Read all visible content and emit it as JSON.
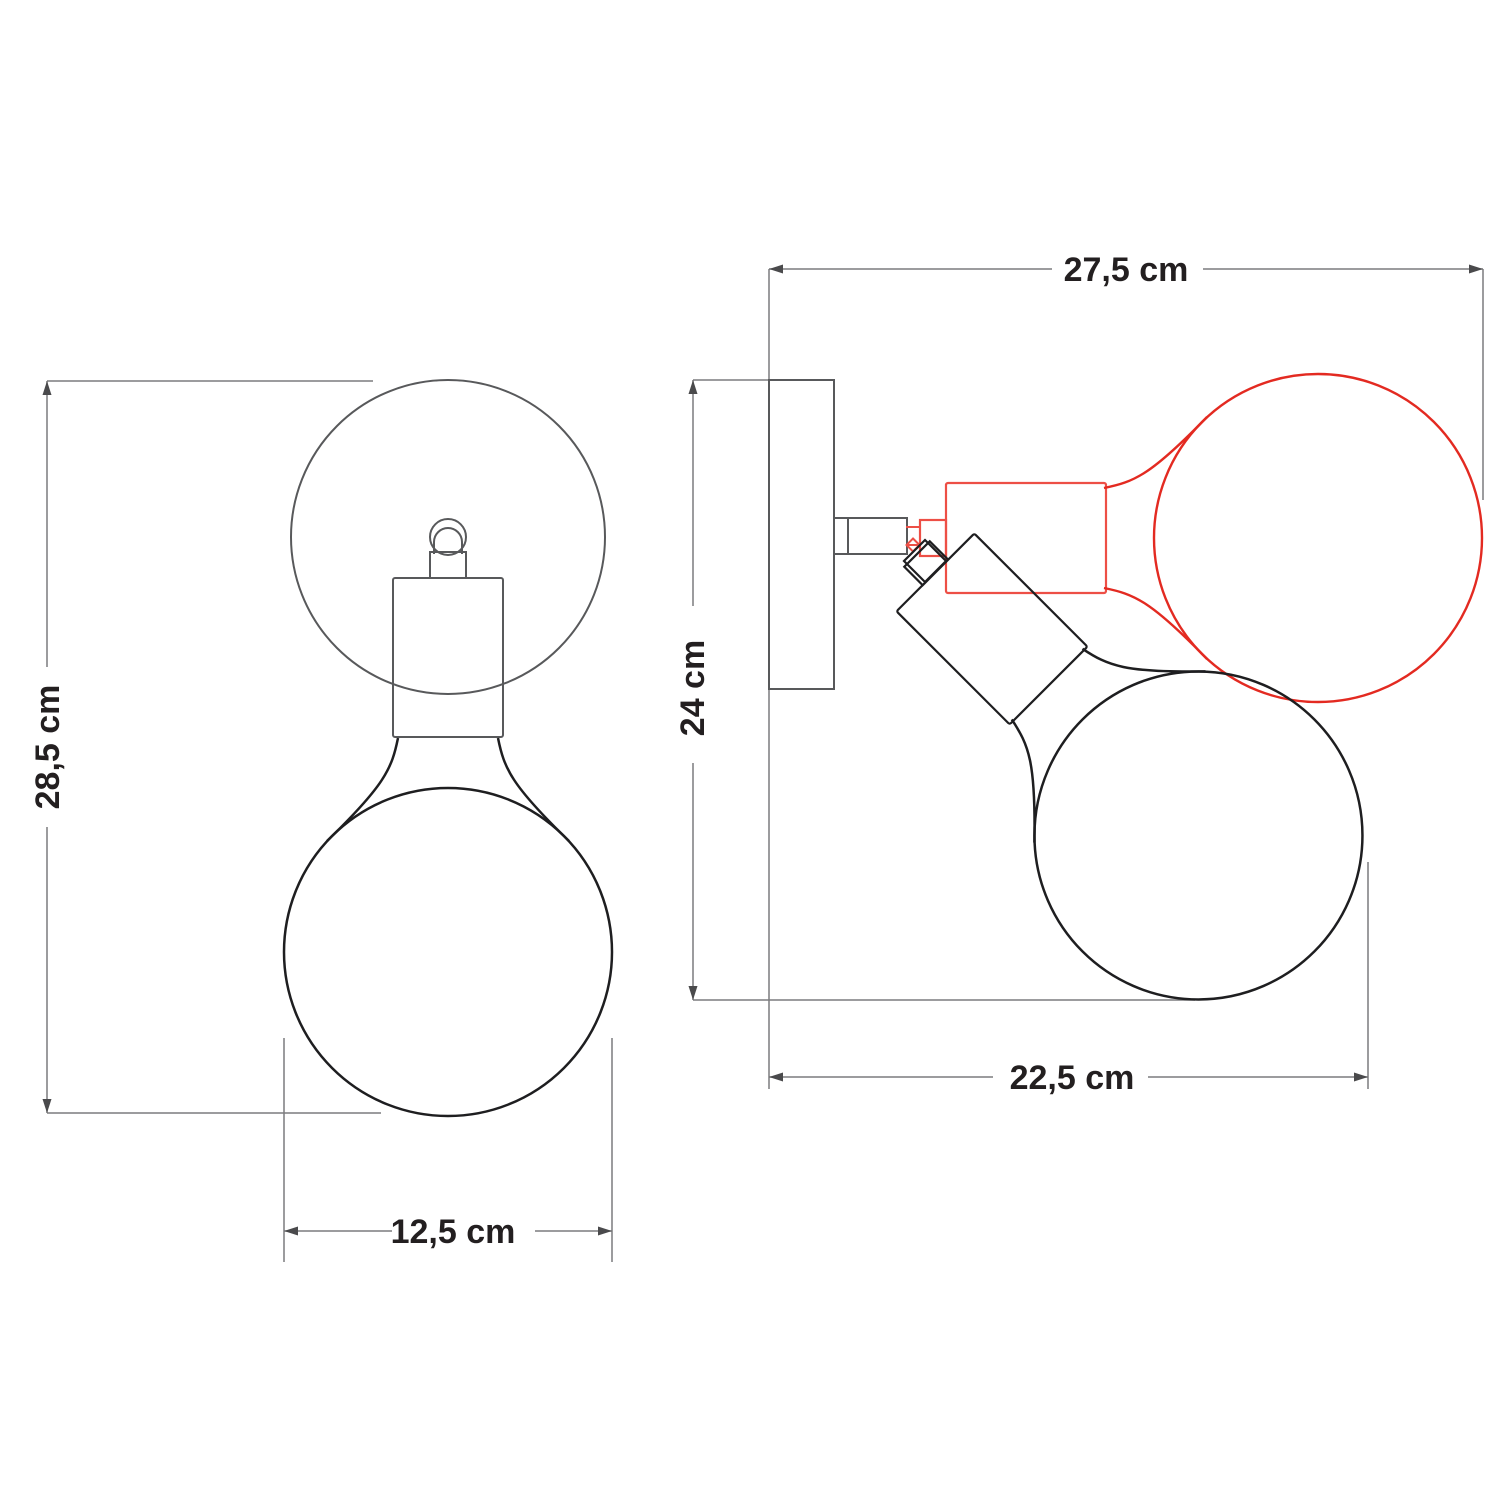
{
  "diagram": {
    "type": "technical dimension drawing",
    "subject": "adjustable wall lamp with globe bulb, front and side views",
    "views": {
      "front": "front-view",
      "side": "side-view-with-rotated-bulb-position"
    },
    "dimensions": {
      "front_height": "28,5 cm",
      "front_width": "12,5 cm",
      "side_width_top": "27,5 cm",
      "side_height": "24 cm",
      "side_width_bottom": "22,5 cm"
    },
    "colors": {
      "hardware_gray": "#58595b",
      "outline_black": "#1e1e20",
      "alt_position_red": "#e32a21",
      "alt_position_red_light": "#ed4f46",
      "dimension_gray": "#7c7c7e",
      "text": "#231f20",
      "background": "#ffffff"
    }
  }
}
